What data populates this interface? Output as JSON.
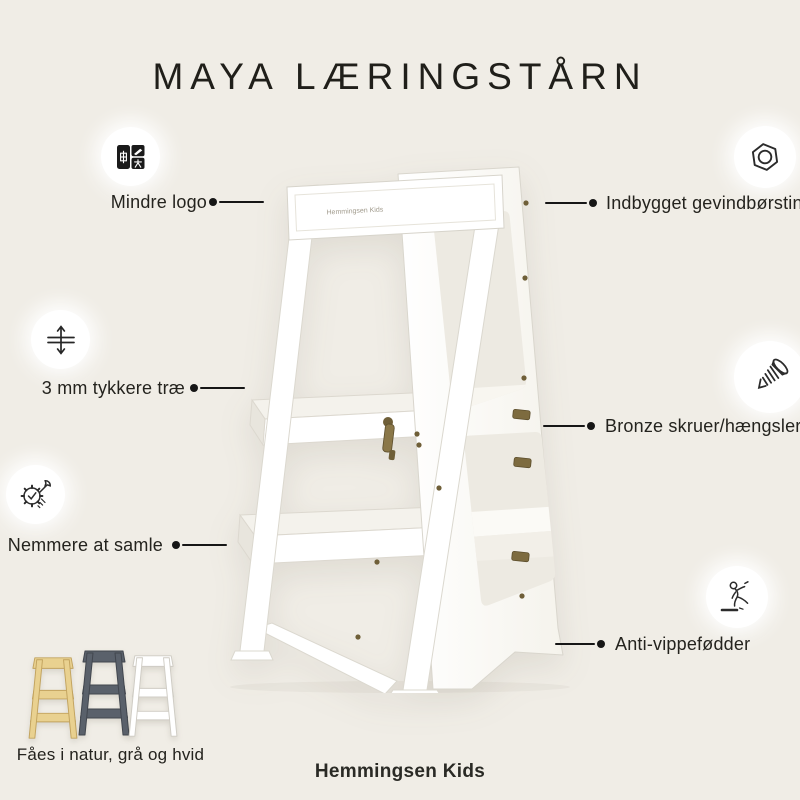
{
  "title": "MAYA LÆRINGSTÅRN",
  "brand": "Hemmingsen Kids",
  "tower": {
    "logo_text": "Hemmingsen Kids"
  },
  "callouts": {
    "left": [
      {
        "icon": "translate-icon",
        "label": "Mindre logo"
      },
      {
        "icon": "thickness-icon",
        "label": "3 mm tykkere træ"
      },
      {
        "icon": "assembly-icon",
        "label": "Nemmere at samle"
      }
    ],
    "right": [
      {
        "icon": "hex-nut-icon",
        "label": "Indbygget gevindbørstin"
      },
      {
        "icon": "screw-icon",
        "label": "Bronze skruer/hængsler"
      },
      {
        "icon": "slipping-person-icon",
        "label": "Anti-vippefødder"
      }
    ]
  },
  "variants": {
    "label": "Fåes i natur, grå og hvid",
    "items": [
      {
        "name": "natur",
        "color": "#e9d190",
        "stroke": "#c2a35e"
      },
      {
        "name": "grå",
        "color": "#5a616b",
        "stroke": "#41464e"
      },
      {
        "name": "hvid",
        "color": "#ffffff",
        "stroke": "#cfccc4"
      }
    ]
  },
  "colors": {
    "background": "#f0ede6",
    "text": "#24231e",
    "callout_line": "#161616",
    "bronze_hardware": "#6f5f38"
  }
}
